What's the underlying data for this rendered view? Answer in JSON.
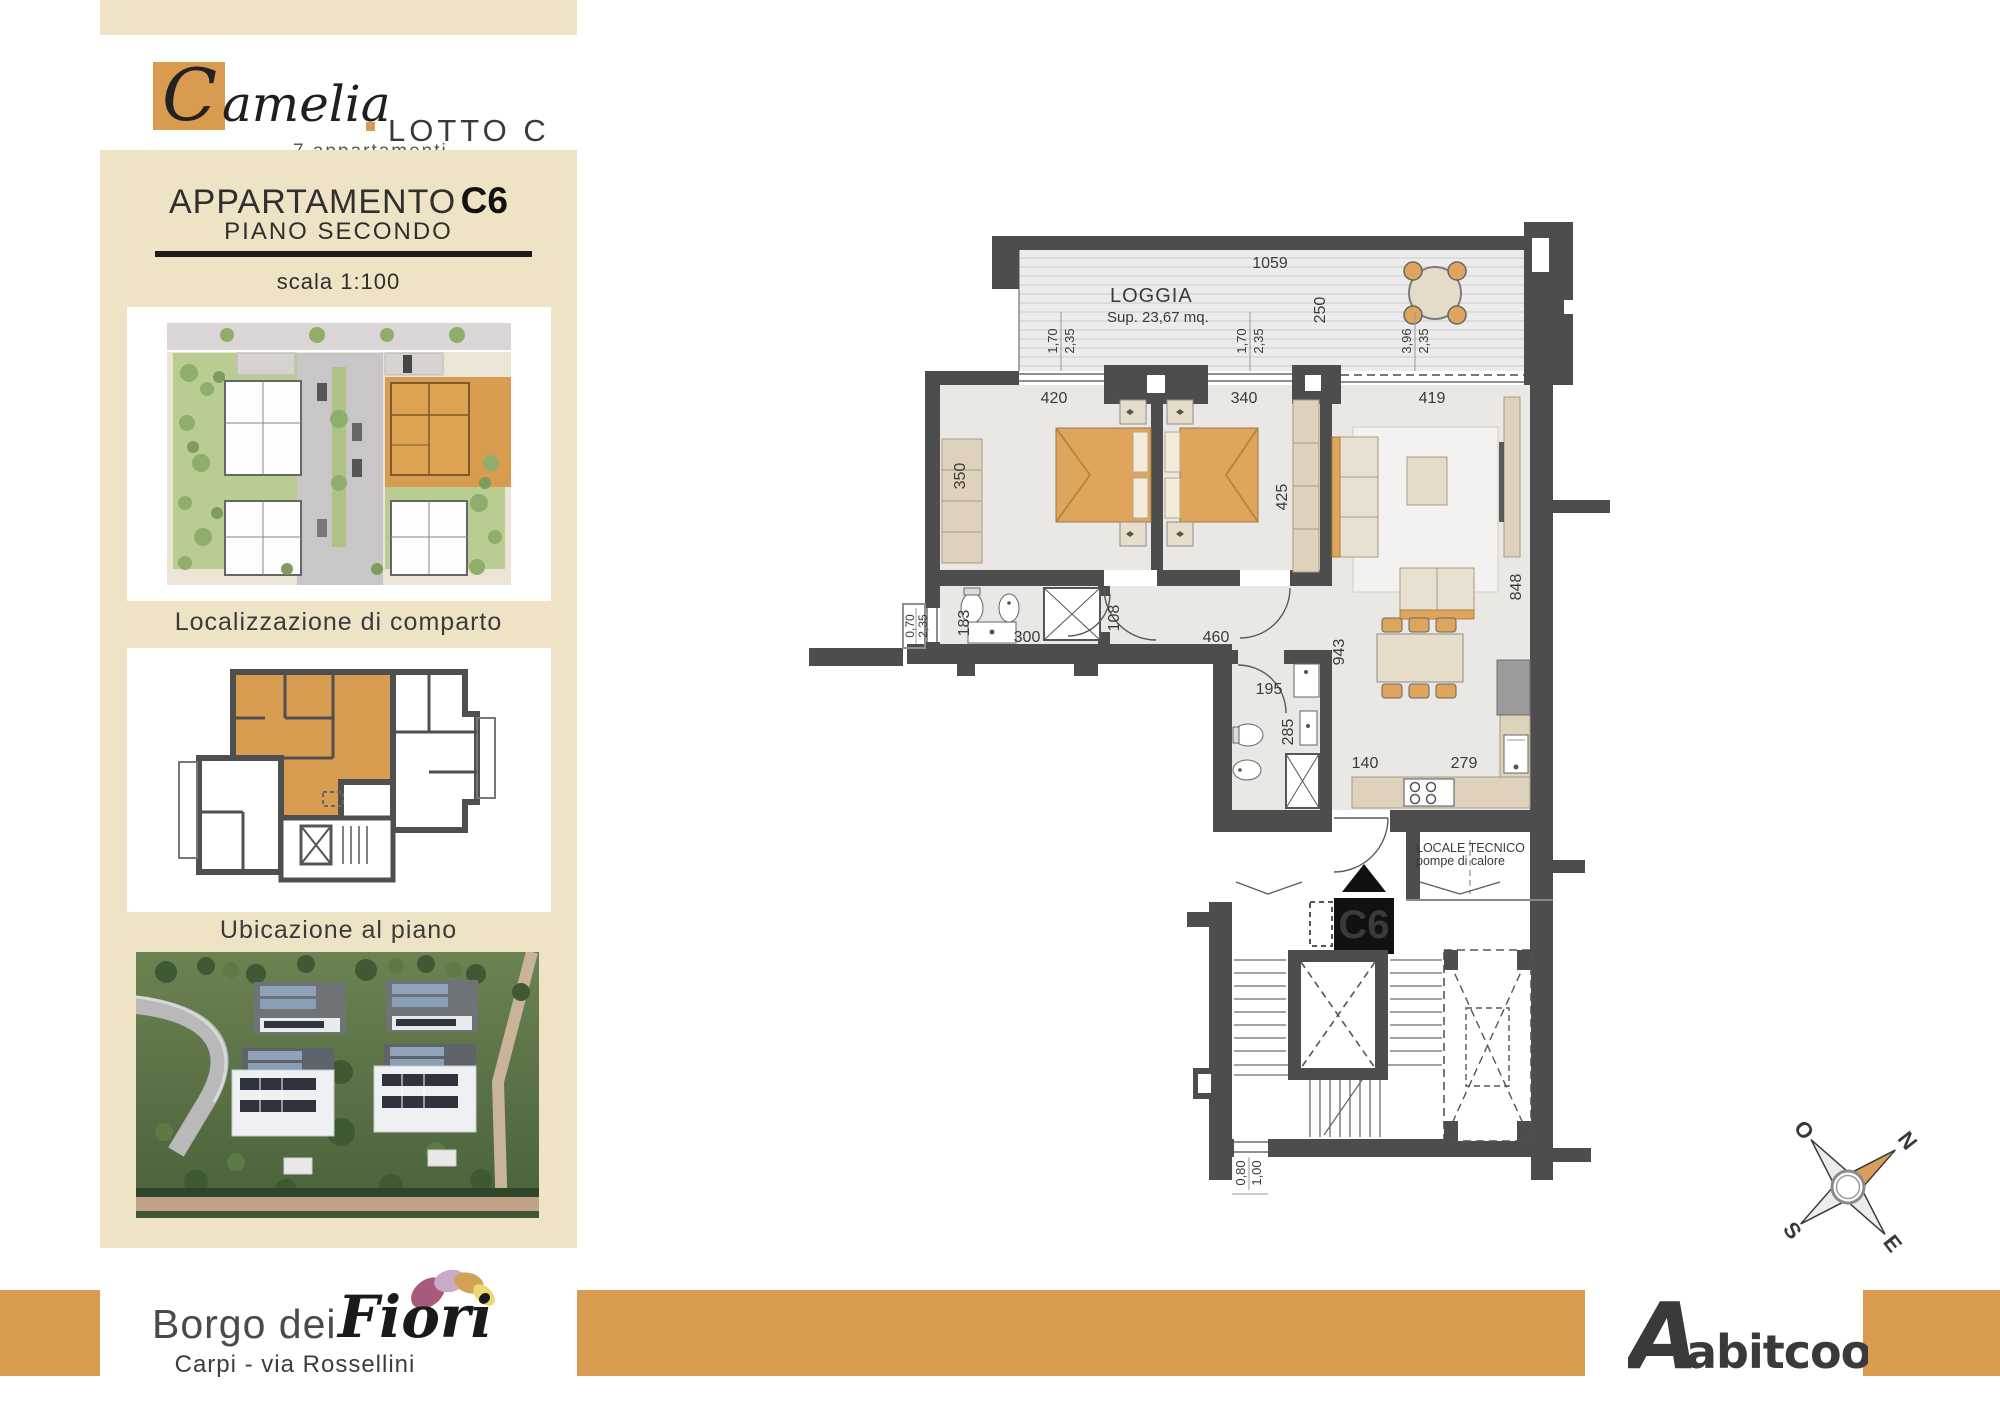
{
  "colors": {
    "beige": "#efe3c6",
    "orange": "#d89b4f",
    "wall_gray": "#4d4d4d",
    "abitcoop_red": "#c8232c",
    "furniture_orange": "#dfa55c"
  },
  "header": {
    "logo_initial": "C",
    "logo_script": "amelia",
    "logo_lot": "LOTTO C",
    "logo_sub": "7 appartamen­ti"
  },
  "sidebar": {
    "title": "APPARTAMENTO",
    "unit": "C6",
    "floor": "PIANO SECONDO",
    "scale_label": "scala 1:100",
    "caption_site": "Localizzazione di comparto",
    "caption_floor": "Ubicazione al piano"
  },
  "plan": {
    "loggia": {
      "name": "LOGGIA",
      "area": "Sup. 23,67 mq.",
      "width": "1059",
      "depth": "250"
    },
    "windows": {
      "w1a": "1,70",
      "w1b": "2,35",
      "w2a": "1,70",
      "w2b": "2,35",
      "w3a": "3,96",
      "w3b": "2,35",
      "bath_a": "0,70",
      "bath_b": "2,35",
      "stair_a": "0,80",
      "stair_b": "1,00"
    },
    "rooms": {
      "bed1_w": "420",
      "bed2_w": "340",
      "living_w": "419",
      "bed1_d": "350",
      "bed2_d": "425",
      "bath1_w": "183",
      "bath1_l": "300",
      "bath1_door": "108",
      "hall": "460",
      "living_l": "943",
      "living_d": "848",
      "bath2_door": "195",
      "bath2_d": "285",
      "kitchen_a": "140",
      "kitchen_b": "279"
    },
    "tech_room": {
      "line1": "LOCALE TECNICO",
      "line2": "pompe di calore"
    },
    "unit_marker": "C6",
    "compass": {
      "n": "N",
      "e": "E",
      "s": "S",
      "o": "O"
    }
  },
  "footer": {
    "project": "Borgo dei",
    "project_script": "Fiori",
    "location": "Carpi - via Rossellini",
    "builder_initial": "A",
    "builder": "abitcoop"
  }
}
